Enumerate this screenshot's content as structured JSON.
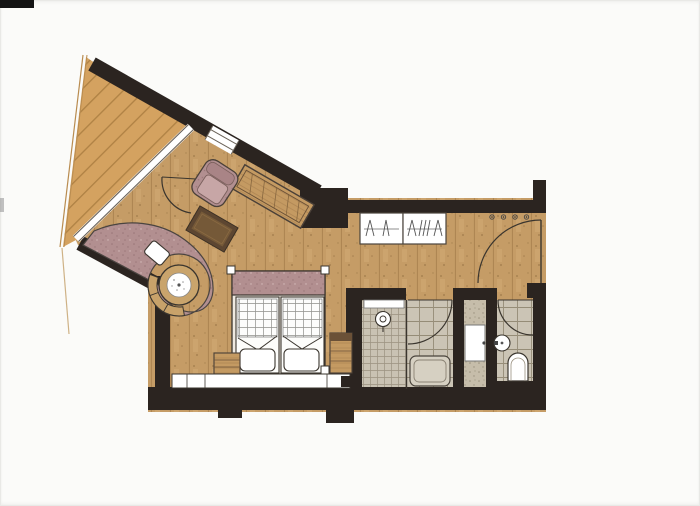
{
  "canvas": {
    "width": 700,
    "height": 506
  },
  "colors": {
    "page": "#fbfbf9",
    "wall": "#2b2420",
    "outline": "#3a352e",
    "deck_wood": "#d4a260",
    "deck_plank_line": "#a5783c",
    "floor_wood": "#c59c66",
    "floor_plank_line": "#97713f",
    "floor_speckle": "#7e5c33",
    "railing": "#b98c50",
    "glass_edge": "#6a6258",
    "mauve": "#b28f90",
    "mauve_speckle": "#8d6a6c",
    "furniture_wood": "#c49a62",
    "dark_wood": "#5d4631",
    "tile": "#cbc4b5",
    "tile_line": "#958c77",
    "shower_tile": "#c9c2b3",
    "shower_tile_line": "#9a9180",
    "stone": "#c6bdaa",
    "stone_speckle": "#8d8470",
    "fixture": "#ffffff",
    "scan_mark": "#141414"
  },
  "plan": {
    "rooms": [
      "terrace",
      "living-bedroom",
      "entry-corridor",
      "shower-room",
      "bathroom",
      "vanity-niche",
      "wc"
    ],
    "furniture": [
      "armchair",
      "daybed-bench",
      "coffee-table",
      "curved-banquette",
      "banquette-pillow",
      "wood-stove",
      "double-bed",
      "bed-pillows",
      "nightstand-left",
      "nightstand-right",
      "headboard-ledge",
      "wardrobe",
      "coat-hooks",
      "shower-head",
      "bathtub",
      "washbasin",
      "toilet",
      "corner-sink"
    ],
    "counts": {
      "coat_hooks": 4,
      "wardrobe_sections": 2,
      "bed_pillows": 2,
      "door_swings": 4
    }
  }
}
